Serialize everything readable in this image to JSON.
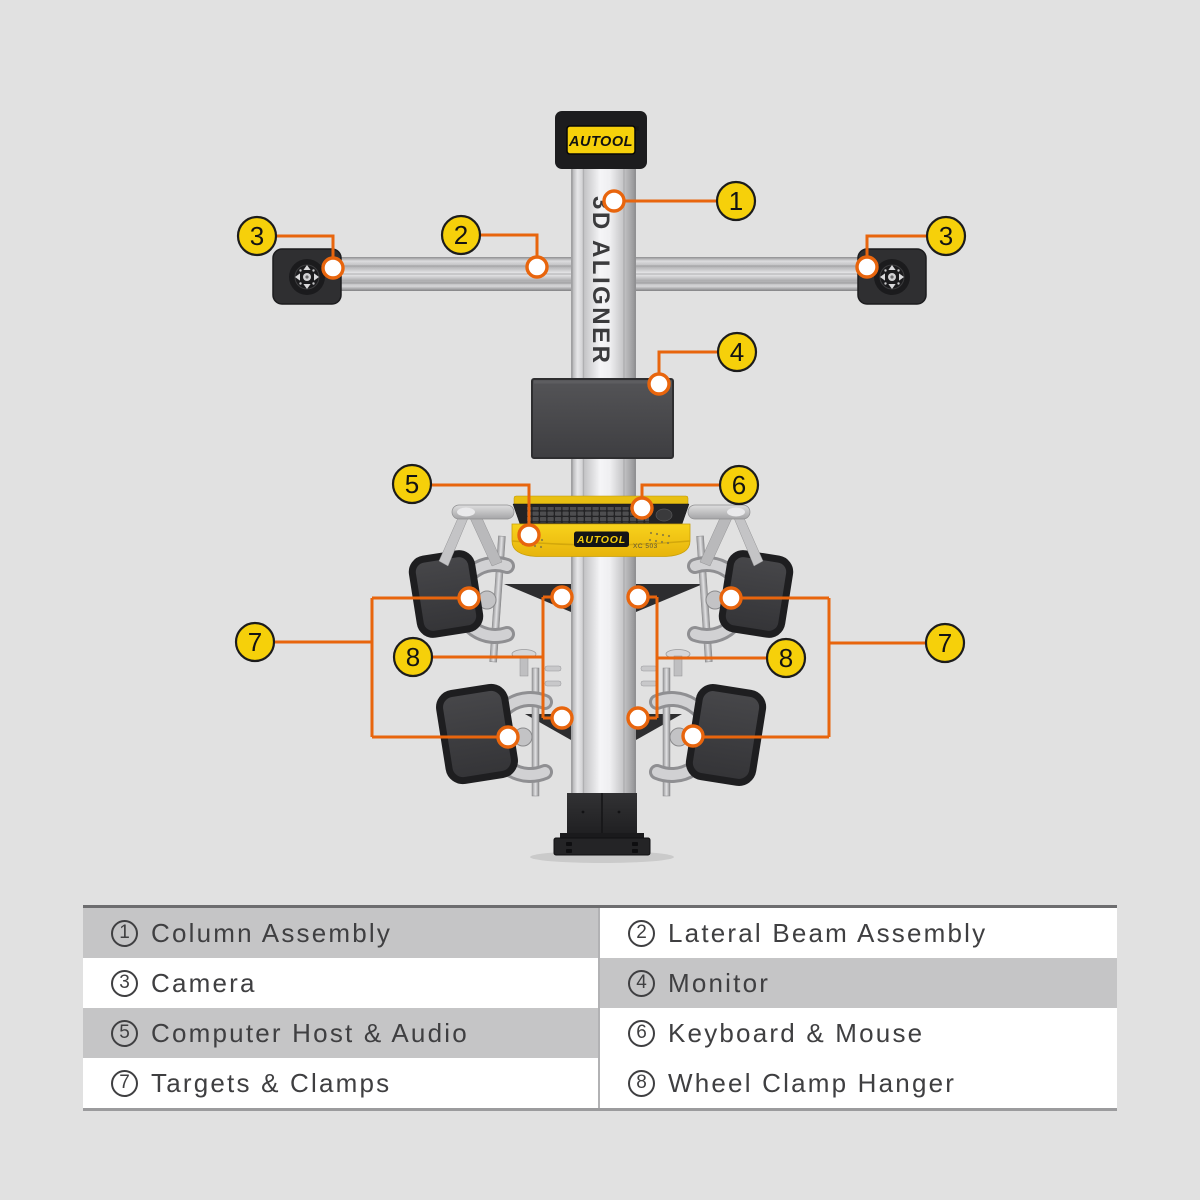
{
  "diagram": {
    "top_logo": "AUTOOL",
    "top_logo_reg": "®",
    "column_label": "3D ALIGNER",
    "tray_logo": "AUTOOL",
    "tray_model": "XC 503",
    "callouts": {
      "c1": "1",
      "c2": "2",
      "c3_left": "3",
      "c3_right": "3",
      "c4": "4",
      "c5": "5",
      "c6": "6",
      "c7_left": "7",
      "c7_right": "7",
      "c8_left": "8",
      "c8_right": "8"
    }
  },
  "legend": {
    "items": [
      {
        "num": "1",
        "label": "Column Assembly"
      },
      {
        "num": "2",
        "label": "Lateral Beam Assembly"
      },
      {
        "num": "3",
        "label": "Camera"
      },
      {
        "num": "4",
        "label": "Monitor"
      },
      {
        "num": "5",
        "label": "Computer Host & Audio"
      },
      {
        "num": "6",
        "label": "Keyboard & Mouse"
      },
      {
        "num": "7",
        "label": "Targets & Clamps"
      },
      {
        "num": "8",
        "label": "Wheel Clamp Hanger"
      }
    ]
  },
  "colors": {
    "background": "#E1E1E1",
    "accent_orange": "#E8650D",
    "callout_yellow": "#F6D00A",
    "table_stripe": "#C5C5C6"
  }
}
